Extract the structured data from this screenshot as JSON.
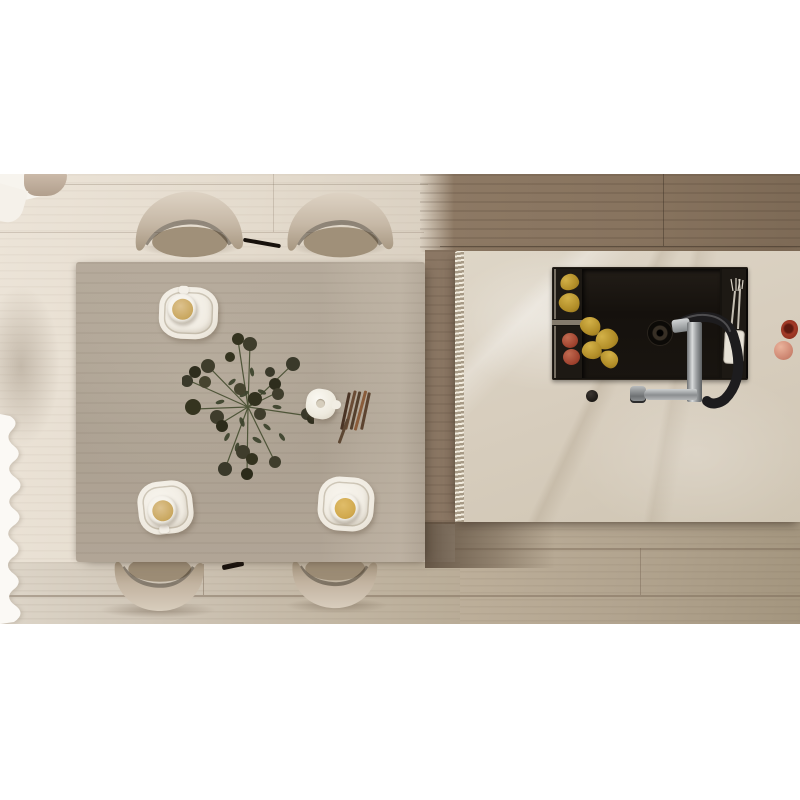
{
  "scene": {
    "title": "Top-down render of a dining table and kitchen island",
    "view": "overhead / bird's-eye",
    "letterbox_color": "#ffffff",
    "photo_band": {
      "top_px": 174,
      "height_px": 450
    }
  },
  "palette": {
    "floor_light": "#e4dbcd",
    "floor_brown": "#8d7964",
    "floor_bottom_tan": "#b2a48f",
    "table_wood": "#b0a596",
    "island_marble": "#d7cdbd",
    "sink_black": "#16130f",
    "chair_fabric": "#cfc2b1",
    "chrome": "#b9bcbd",
    "hose_black": "#1d1c1e",
    "pear_yellow": "#b08c27",
    "onion_red": "#a0432f",
    "apple_pink": "#d08a75",
    "pomegranate_red": "#a33a27",
    "drink_tan": "#c9a75f",
    "curtain_white": "#faf8f4"
  },
  "objects": {
    "dining_table": {
      "label": "rectangular light-wood dining table"
    },
    "chairs": {
      "count": 4,
      "label": "curved upholstered dining chairs",
      "positions": [
        "top-left",
        "top-right",
        "bottom-left",
        "bottom-right"
      ]
    },
    "place_settings": {
      "count": 3,
      "items": [
        "square white plate",
        "saucer",
        "coffee cup with drink"
      ]
    },
    "bouquet": {
      "label": "dark dried flower bouquet laid on table"
    },
    "teapot": {
      "label": "small white teapot"
    },
    "sticks": {
      "label": "bundle of dried brown sticks"
    },
    "kitchen_island": {
      "label": "cream marble island with fluted left edge"
    },
    "sink": {
      "label": "black workstation sink",
      "contents": [
        "pears in left caddy",
        "red onions in left caddy",
        "pears in basin",
        "drain",
        "cutlery in right caddy",
        "white towel"
      ]
    },
    "faucet": {
      "label": "chrome pull-down faucet with black spring hose"
    },
    "counter_fruit": {
      "items": [
        "cut pomegranate",
        "whole apple"
      ]
    },
    "curtain": {
      "label": "white curtain edge, bottom-left"
    },
    "corner_furniture": {
      "label": "armchair with white throw, top-left corner"
    }
  }
}
